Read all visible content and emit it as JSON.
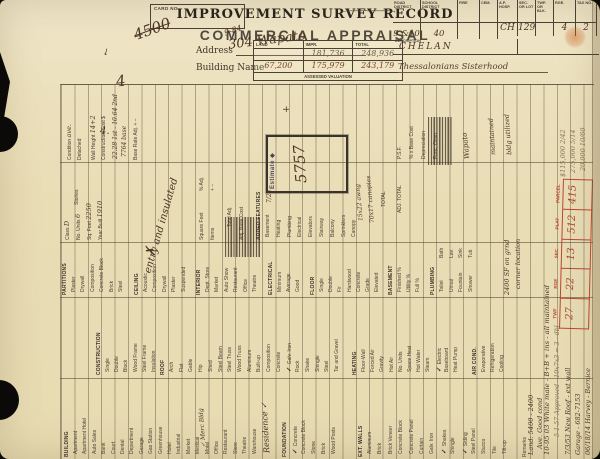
{
  "header": {
    "card_no_label": "CARD NO.",
    "title": "IMPROVEMENT SURVEY RECORD",
    "subtitle": "COMMERCIAL APPRAISAL",
    "arrow": "←——————→",
    "address_label": "Address",
    "address_value": "304 Wapato",
    "building_name_label": "Building Name",
    "marks": {
      "crossed_number": "4500",
      "date_note": "9-84",
      "flourish": "4",
      "small_four": "4.",
      "arrow_down": "↓"
    },
    "valuation": {
      "caption": "ASSESSED VALUATION",
      "columns": [
        "LAND",
        "IMPR.",
        "TOTAL"
      ],
      "rows": [
        [
          "",
          "181,736",
          "248,936"
        ],
        [
          "67,200",
          "175,979",
          "243,179"
        ]
      ]
    },
    "district": {
      "columns": [
        "ROAD DISTRICT",
        "SCHOOL DISTRICT",
        "FIRE",
        "CEM.",
        "A.P. HOSP.",
        "SEC. OR LOT",
        "TWP. OR BLK.",
        "RGE.",
        "TAX NO."
      ],
      "values": [
        "CH",
        "129",
        "",
        "4",
        "2",
        "9 &10",
        "40",
        "",
        ""
      ],
      "description_label": "DESCRIPTION",
      "description_value": "CHELAN",
      "note": "Thessalonians Sisterhood"
    }
  },
  "body": {
    "sections": [
      {
        "id": "building",
        "title": "BUILDING",
        "items": [
          {
            "t": "Apartment"
          },
          {
            "t": "Apartment Hotel"
          },
          {
            "t": "Auto Sales"
          },
          {
            "t": "Bank"
          },
          {
            "t": "Court"
          },
          {
            "t": "Dental"
          },
          {
            "t": "Department"
          },
          {
            "t": "Garage"
          },
          {
            "t": "Gas Station"
          },
          {
            "t": "Greenhouse"
          },
          {
            "t": "Hotel"
          },
          {
            "t": "Industrial"
          },
          {
            "t": "Market"
          },
          {
            "t": "Medical"
          },
          {
            "t": "Motel"
          },
          {
            "t": "Office"
          },
          {
            "t": "Restaurant"
          },
          {
            "t": "Store"
          },
          {
            "t": "Theatre"
          },
          {
            "t": "Warehouse"
          }
        ]
      },
      {
        "id": "foundation",
        "title": "FOUNDATION",
        "items": [
          {
            "t": "Concrete",
            "chk": true
          },
          {
            "t": "Concrete Block"
          },
          {
            "t": "Stone"
          },
          {
            "t": "Brick"
          },
          {
            "t": "Wood Posts"
          }
        ]
      },
      {
        "id": "extwalls",
        "title": "EXT. WALLS",
        "items": [
          {
            "t": "Aluminum"
          },
          {
            "t": "Brick"
          },
          {
            "t": "Brick Veneer"
          },
          {
            "t": "Concrete Block"
          },
          {
            "t": "Concrete Panel"
          },
          {
            "t": "Curtain"
          },
          {
            "t": "Galv. Iron"
          },
          {
            "t": "Shakes",
            "chk": true
          },
          {
            "t": "Shingle"
          },
          {
            "t": "Siding",
            "chk": true
          },
          {
            "t": "Steel Panel"
          },
          {
            "t": "Stucco"
          },
          {
            "t": "Tile"
          },
          {
            "t": "Tilt-up"
          }
        ]
      },
      {
        "id": "construction",
        "title": "CONSTRUCTION",
        "items": [
          {
            "t": "Single"
          },
          {
            "t": "Double"
          },
          {
            "t": "Block"
          },
          {
            "t": "Wood Frame"
          },
          {
            "t": "Steel Frame"
          },
          {
            "t": "Insulation"
          }
        ]
      },
      {
        "id": "roof",
        "title": "ROOF",
        "items": [
          {
            "t": "Arch"
          },
          {
            "t": "Flat"
          },
          {
            "t": "Gable"
          },
          {
            "t": "Hip"
          },
          {
            "t": "Shed"
          },
          {
            "t": "Steel Beam"
          },
          {
            "t": "Steel Truss"
          },
          {
            "t": "Wood Truss"
          },
          {
            "t": "Aluminum"
          },
          {
            "t": "Built-up"
          },
          {
            "t": "Composition"
          },
          {
            "t": "Concrete"
          },
          {
            "t": "Galv. Iron",
            "chk": true
          },
          {
            "t": "Rock"
          },
          {
            "t": "Shake"
          },
          {
            "t": "Shingle"
          },
          {
            "t": "Steel"
          },
          {
            "t": "Tar and Gravel"
          }
        ]
      },
      {
        "id": "heating",
        "title": "HEATING",
        "items": [
          {
            "t": "Floor-Wall"
          },
          {
            "t": "Forced Air"
          },
          {
            "t": "Gravity"
          },
          {
            "t": "Hot Air"
          },
          {
            "t": "No. Units"
          },
          {
            "t": "Space Heat"
          },
          {
            "t": "Hot Water"
          },
          {
            "t": "Steam"
          },
          {
            "t": "Electric",
            "chk": true
          },
          {
            "t": "Baseboard"
          },
          {
            "t": "Heat Pump"
          }
        ]
      },
      {
        "id": "aircond",
        "title": "AIR COND.",
        "items": [
          {
            "t": "Evaporative"
          },
          {
            "t": "Refrigeration"
          },
          {
            "t": "Cooling"
          }
        ]
      },
      {
        "id": "partitions",
        "title": "PARTITIONS",
        "items": [
          {
            "t": "Plaster"
          },
          {
            "t": "Drywall"
          },
          {
            "t": "Composition"
          },
          {
            "t": "Concrete Block"
          },
          {
            "t": "Brick"
          },
          {
            "t": "Steel"
          }
        ]
      },
      {
        "id": "ceiling",
        "title": "CEILING",
        "items": [
          {
            "t": "Acoustic"
          },
          {
            "t": "Composition"
          },
          {
            "t": "Drywall"
          },
          {
            "t": "Plaster"
          },
          {
            "t": "Suspended"
          }
        ]
      },
      {
        "id": "interior",
        "title": "INTERIOR",
        "items": [
          {
            "t": "Dept. Store"
          },
          {
            "t": "Market"
          },
          {
            "t": "Auto Show"
          },
          {
            "t": "Restaurant"
          },
          {
            "t": "Office"
          },
          {
            "t": "Theatre"
          }
        ]
      },
      {
        "id": "electrical",
        "title": "ELECTRICAL",
        "items": [
          {
            "t": "Minimum"
          },
          {
            "t": "Average"
          },
          {
            "t": "Good"
          }
        ]
      },
      {
        "id": "floor",
        "title": "FLOOR",
        "items": [
          {
            "t": "Single"
          },
          {
            "t": "Double"
          },
          {
            "t": "Fir"
          },
          {
            "t": "Hardwood"
          },
          {
            "t": "Concrete"
          },
          {
            "t": "Grade"
          },
          {
            "t": "Elevated"
          }
        ]
      },
      {
        "id": "basement",
        "title": "BASEMENT",
        "items": [
          {
            "t": "Finished  %"
          },
          {
            "t": "Utility  %"
          },
          {
            "t": "Full  %"
          }
        ]
      },
      {
        "id": "plumbing",
        "title": "PLUMBING",
        "items": [
          {
            "t": "Toilet"
          },
          {
            "t": "Urinal"
          },
          {
            "t": "Fountain"
          },
          {
            "t": "Shower"
          }
        ]
      },
      {
        "id": "plumbing2",
        "title": "",
        "items": [
          {
            "t": "Bath"
          },
          {
            "t": "Lav."
          },
          {
            "t": "Sink"
          },
          {
            "t": "Tub"
          }
        ]
      },
      {
        "id": "added",
        "title": "ADDED FEATURES",
        "items": [
          {
            "t": "Basement"
          },
          {
            "t": "Heating"
          },
          {
            "t": "Plumbing"
          },
          {
            "t": "Electrical"
          },
          {
            "t": "Elevators"
          },
          {
            "t": "Stairway"
          },
          {
            "t": "Balcony"
          },
          {
            "t": "Sprinklers"
          },
          {
            "t": "Canopy"
          }
        ]
      }
    ],
    "fields": [
      {
        "id": "class",
        "label": "Class",
        "value": "D"
      },
      {
        "id": "units",
        "label": "No. Units",
        "value": "6"
      },
      {
        "id": "stories",
        "label": "Stories",
        "value": ""
      },
      {
        "id": "sqfeet",
        "label": "Sq. Feet",
        "value": "2250"
      },
      {
        "id": "yearbuilt",
        "label": "Year Built",
        "value": "1910"
      },
      {
        "id": "squarefeet2",
        "label": "Square Feet",
        "value": ""
      },
      {
        "id": "items2",
        "label": "Items",
        "value": ""
      },
      {
        "id": "pctadj",
        "label": "% Adj.",
        "value": ""
      },
      {
        "id": "plusminus",
        "label": "+    −",
        "value": ""
      },
      {
        "id": "totaladj",
        "label": "Total Adj.",
        "value": ""
      },
      {
        "id": "adjbase",
        "label": "Adj. Base Cost",
        "value": ""
      },
      {
        "id": "total",
        "label": "TOTAL",
        "value": ""
      },
      {
        "id": "adjtotal",
        "label": "ADJ. TOTAL",
        "value": ""
      },
      {
        "id": "condition",
        "label": "Condition",
        "value": "ave."
      },
      {
        "id": "detached",
        "label": "Detached",
        "value": ""
      },
      {
        "id": "wallheight",
        "label": "Wall Height",
        "value": "14+2"
      },
      {
        "id": "constcost",
        "label": "Construction Cost $",
        "value": ""
      },
      {
        "id": "baserate",
        "label": "Base Rate Adj.   +   −",
        "value": ""
      },
      {
        "id": "psf",
        "label": "P.S.F.",
        "value": ""
      },
      {
        "id": "pctbase",
        "label": "% x Base Cost",
        "value": ""
      },
      {
        "id": "deprec",
        "label": "Depreciation",
        "value": ""
      },
      {
        "id": "funcobso",
        "label": "Func. Obso.",
        "value": ""
      },
      {
        "id": "remarks",
        "label": "Remarks",
        "value": ""
      }
    ],
    "estimate": {
      "label": "Estimate ◆",
      "value": "5757"
    },
    "parcel": {
      "fields": [
        {
          "label": "TWP",
          "value": "27"
        },
        {
          "label": "RGE",
          "value": "22"
        },
        {
          "label": "SEC",
          "value": "13"
        },
        {
          "label": "PLAT",
          "value": "512"
        },
        {
          "label": "PARCEL",
          "value": "415"
        }
      ]
    },
    "annotations": [
      {
        "id": "merc",
        "text": "✓ Merc Bldg",
        "kind": "ink"
      },
      {
        "id": "res",
        "text": "Residence ✓",
        "kind": "ink"
      },
      {
        "id": "xmark",
        "text": "✗",
        "kind": "ink"
      },
      {
        "id": "entry",
        "text": "entry and insulated",
        "kind": "ink"
      },
      {
        "id": "sf2400",
        "text": "2400 SF on grnd",
        "kind": "ink"
      },
      {
        "id": "corner",
        "text": "corner location",
        "kind": "ink"
      },
      {
        "id": "can1",
        "text": "15x22 awng",
        "kind": "ink"
      },
      {
        "id": "can2",
        "text": "70x17 canopies",
        "kind": "ink"
      },
      {
        "id": "b724",
        "text": "7/24",
        "kind": "ink"
      },
      {
        "id": "plus2",
        "text": "+",
        "kind": "ink"
      },
      {
        "id": "wapato",
        "text": "Wapato",
        "kind": "ink"
      },
      {
        "id": "maint",
        "text": "maintained",
        "kind": "ink"
      },
      {
        "id": "util",
        "text": "bldg utilized",
        "kind": "ink"
      },
      {
        "id": "long1",
        "text": "10-95 03 White male - B+B + ins - all maintained",
        "kind": "ink"
      },
      {
        "id": "appr",
        "text": "5-1-57 Approved - 10x7x3 = 3 - dbl",
        "kind": "pencil"
      },
      {
        "id": "land",
        "text": "Land: 5400 - 2400",
        "kind": "ink"
      },
      {
        "id": "ave",
        "text": "Ave. Good cond",
        "kind": "ink"
      },
      {
        "id": "r1",
        "text": "7/3/53 New Roof - ext wall",
        "kind": "ink"
      },
      {
        "id": "r2",
        "text": "Garage - 682-7153",
        "kind": "ink"
      },
      {
        "id": "r3",
        "text": "06/18/14 Harvey - Bernice",
        "kind": "ink"
      },
      {
        "id": "p1",
        "text": "$115,000 2/42",
        "kind": "pencil"
      },
      {
        "id": "p2",
        "text": "275,000 5/14",
        "kind": "pencil"
      },
      {
        "id": "p3",
        "text": "20,000 10/60",
        "kind": "pencil"
      },
      {
        "id": "cc1",
        "text": "22.28 1st - 10.64 2nd",
        "kind": "ink"
      },
      {
        "id": "cc2",
        "text": "7764 base",
        "kind": "ink"
      }
    ]
  }
}
